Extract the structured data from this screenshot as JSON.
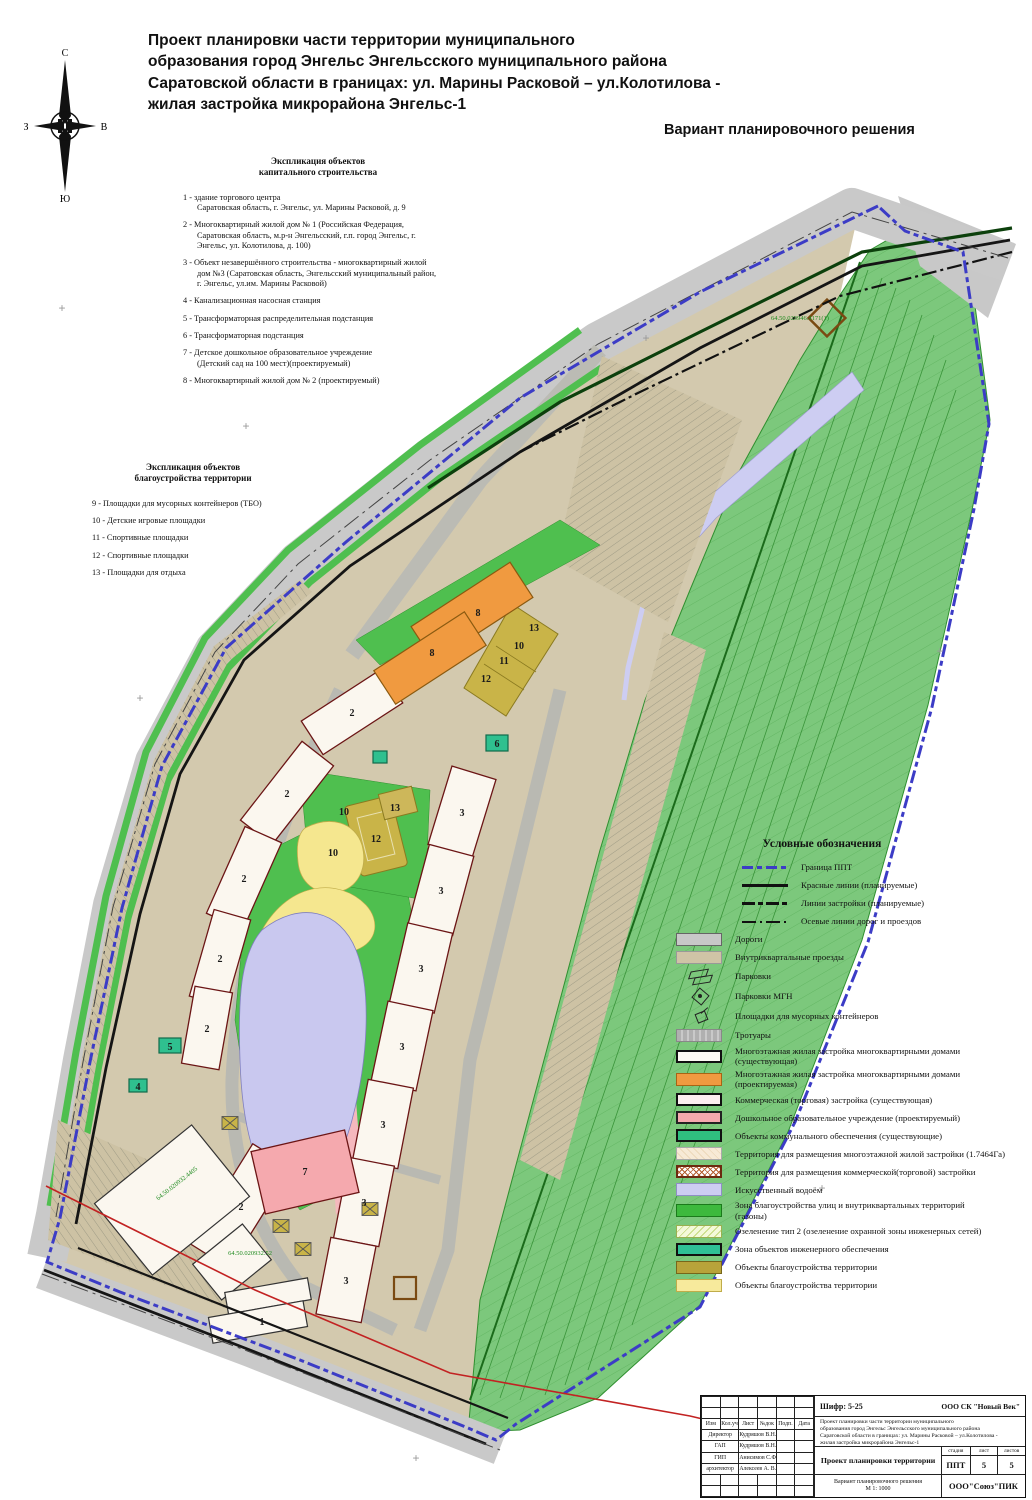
{
  "page": {
    "title": "Проект планировки части территории муниципального\nобразования город Энгельс Энгельсского муниципального района\nСаратовской области в границах: ул. Марины Расковой – ул.Колотилова -\nжилая застройка микрорайона Энгельс-1",
    "variant_label": "Вариант планировочного решения"
  },
  "compass": {
    "north": "С",
    "south": "Ю",
    "west": "З",
    "east": "В"
  },
  "explication_capital": {
    "heading": "Экспликация объектов\nкапитального строительства",
    "items": [
      {
        "num": "1",
        "text": "здание торгового центра\nСаратовская область, г. Энгельс, ул. Марины Расковой, д. 9"
      },
      {
        "num": "2",
        "text": "Многоквартирный жилой дом № 1 (Российская Федерация,\nСаратовская область, м.р-н Энгельсский, г.п. город Энгельс, г.\nЭнгельс, ул. Колотилова, д. 100)"
      },
      {
        "num": "3",
        "text": "Объект незавершённого строительства - многоквартирный жилой\nдом №3 (Саратовская область, Энгельсский муниципальный район,\nг. Энгельс, ул.им. Марины Расковой)"
      },
      {
        "num": "4",
        "text": "Канализационная насосная станция"
      },
      {
        "num": "5",
        "text": "Трансформаторная распределительная подстанция"
      },
      {
        "num": "6",
        "text": "Трансформаторная подстанция"
      },
      {
        "num": "7",
        "text": "Детское дошкольное образовательное учреждение\n(Детский сад на 100 мест)(проектируемый)"
      },
      {
        "num": "8",
        "text": "Многоквартирный жилой дом № 2 (проектируемый)"
      }
    ]
  },
  "explication_landscaping": {
    "heading": "Экспликация объектов\nблагоустройства территории",
    "items": [
      {
        "num": "9",
        "text": "Площадки для мусорных контейнеров (ТБО)"
      },
      {
        "num": "10",
        "text": "Детские игровые площадки"
      },
      {
        "num": "11",
        "text": "Спортивные площадки"
      },
      {
        "num": "12",
        "text": "Спортивные площадки"
      },
      {
        "num": "13",
        "text": "Площадки для отдыха"
      }
    ]
  },
  "legend": {
    "heading": "Условные обозначения",
    "line_items": [
      {
        "name": "ppt-boundary",
        "label": "Граница ППТ",
        "swatch": "sw-boundary"
      },
      {
        "name": "red-lines",
        "label": "Красные линии (планируемые)",
        "swatch": "sw-redline"
      },
      {
        "name": "building-lines",
        "label": "Линии застройки (планируемые)",
        "swatch": "sw-buildline"
      },
      {
        "name": "axis-lines",
        "label": "Осевые линии дорог и проездов",
        "swatch": "sw-axis"
      }
    ],
    "area_items": [
      {
        "name": "roads",
        "label": "Дороги",
        "swatch": "sw-road"
      },
      {
        "name": "inner-drives",
        "label": "Внутриквартальные проезды",
        "swatch": "sw-drive"
      },
      {
        "name": "parkings",
        "label": "Парковки",
        "swatch": "sw-parking",
        "icon": "parking-icon"
      },
      {
        "name": "parkings-mgn",
        "label": "Парковки МГН",
        "swatch": "sw-mgn",
        "icon": "mgn-parking-icon"
      },
      {
        "name": "trash-pads",
        "label": "Площадки для мусорных контейнеров",
        "swatch": "sw-trash",
        "icon": "trash-pad-icon"
      },
      {
        "name": "sidewalks",
        "label": "Тротуары",
        "swatch": "sw-sidewalk"
      },
      {
        "name": "residential-existing",
        "label": "Многоэтажная жилая застройка многоквартирными домами\n(существующая)",
        "swatch": "sw-res-exist"
      },
      {
        "name": "residential-planned",
        "label": "Многоэтажная жилая застройка многоквартирными домами\n(проектируемая)",
        "swatch": "sw-res-plan"
      },
      {
        "name": "commercial-existing",
        "label": "Коммерческая (торговая) застройка (существующая)",
        "swatch": "sw-comm"
      },
      {
        "name": "preschool-planned",
        "label": "Дошкольное образовательное учреждение (проектируемый)",
        "swatch": "sw-dou"
      },
      {
        "name": "utility-objects",
        "label": "Объекты коммунального обеспечения (существующие)",
        "swatch": "sw-utility"
      },
      {
        "name": "territory-residential",
        "label": "Территория для размещения многоэтажной жилой застройки (1.7464Га)",
        "swatch": "sw-terr-res"
      },
      {
        "name": "territory-commercial",
        "label": "Территория для размещения коммерческой(торговой) застройки",
        "swatch": "sw-terr-comm"
      },
      {
        "name": "artificial-pond",
        "label": "Искусственный водоём",
        "swatch": "sw-pond"
      },
      {
        "name": "lawns",
        "label": "Зона благоустройства улиц и внутриквартальных территорий\n(газоны)",
        "swatch": "sw-lawn"
      },
      {
        "name": "greenery-type2",
        "label": "Озеленение тип 2 (озеленение охранной зоны инженерных сетей)",
        "swatch": "sw-green2"
      },
      {
        "name": "engineering-zone",
        "label": "Зона объектов инженерного обеспечения",
        "swatch": "sw-engzone"
      },
      {
        "name": "landscaping-objects-olive",
        "label": "Объекты благоустройства территории",
        "swatch": "sw-blag-olive"
      },
      {
        "name": "landscaping-objects-yellow",
        "label": "Объекты благоустройства территории",
        "swatch": "sw-blag-yellow"
      }
    ]
  },
  "map": {
    "labels": [
      {
        "t": "1",
        "x": 262,
        "y": 1325
      },
      {
        "t": "2",
        "x": 352,
        "y": 716
      },
      {
        "t": "2",
        "x": 287,
        "y": 797
      },
      {
        "t": "2",
        "x": 244,
        "y": 882
      },
      {
        "t": "2",
        "x": 220,
        "y": 962
      },
      {
        "t": "2",
        "x": 207,
        "y": 1032
      },
      {
        "t": "2",
        "x": 241,
        "y": 1210
      },
      {
        "t": "3",
        "x": 462,
        "y": 816
      },
      {
        "t": "3",
        "x": 441,
        "y": 894
      },
      {
        "t": "3",
        "x": 421,
        "y": 972
      },
      {
        "t": "3",
        "x": 402,
        "y": 1050
      },
      {
        "t": "3",
        "x": 383,
        "y": 1128
      },
      {
        "t": "3",
        "x": 364,
        "y": 1206
      },
      {
        "t": "3",
        "x": 346,
        "y": 1284
      },
      {
        "t": "4",
        "x": 138,
        "y": 1090
      },
      {
        "t": "5",
        "x": 170,
        "y": 1050
      },
      {
        "t": "6",
        "x": 497,
        "y": 747
      },
      {
        "t": "7",
        "x": 305,
        "y": 1175
      },
      {
        "t": "8",
        "x": 478,
        "y": 616
      },
      {
        "t": "8",
        "x": 432,
        "y": 656
      },
      {
        "t": "10",
        "x": 519,
        "y": 649
      },
      {
        "t": "11",
        "x": 504,
        "y": 664
      },
      {
        "t": "12",
        "x": 486,
        "y": 682
      },
      {
        "t": "13",
        "x": 534,
        "y": 631
      },
      {
        "t": "10",
        "x": 344,
        "y": 815
      },
      {
        "t": "10",
        "x": 333,
        "y": 856
      },
      {
        "t": "12",
        "x": 376,
        "y": 842
      },
      {
        "t": "13",
        "x": 395,
        "y": 811
      },
      {
        "t": "64.50.020932.4405",
        "x": 178,
        "y": 1185,
        "cls": "map-cad",
        "r": -38
      },
      {
        "t": "64.50.020932.52",
        "x": 250,
        "y": 1255,
        "cls": "map-cad",
        "r": 0
      },
      {
        "t": "64.50.020946.4171(1)",
        "x": 800,
        "y": 320,
        "cls": "map-cad",
        "r": 0
      }
    ],
    "geo_crosses": [
      {
        "x": 62,
        "y": 312
      },
      {
        "x": 140,
        "y": 702
      },
      {
        "x": 646,
        "y": 342
      },
      {
        "x": 940,
        "y": 655
      },
      {
        "x": 822,
        "y": 1192
      },
      {
        "x": 416,
        "y": 1462
      },
      {
        "x": 246,
        "y": 430
      }
    ]
  },
  "stamp": {
    "cipher": "Шифр: 5-25",
    "company_top": "ООО СК \"Новый Век\"",
    "project_desc": "Проект планировки части территории муниципального\nобразования город Энгельс Энгельсского муниципального района\nСаратовской области в границах: ул. Марины Расковой – ул.Колотилова -\nжилая застройка микрорайона Энгельс-1",
    "doc_title": "Проект планировки территории",
    "header_cells": [
      "Изм",
      "Кол.уч",
      "Лист",
      "№док",
      "Подп.",
      "Дата"
    ],
    "roles": [
      [
        "Директор",
        "Кудряшов В.Н."
      ],
      [
        "ГАП",
        "Кудряшов В.Н."
      ],
      [
        "ГИП",
        "Анисимов С.Ф"
      ],
      [
        "архитектор",
        "Алексеев А. В."
      ]
    ],
    "stage_label": "стадия",
    "sheet_label": "лист",
    "sheets_label": "листов",
    "stage": "ППТ",
    "sheet": "5",
    "sheets": "5",
    "variant_title": "Вариант планировочного решения",
    "scale": "М 1: 1000",
    "company_bottom": "ООО\"Союз\"ПИК"
  }
}
